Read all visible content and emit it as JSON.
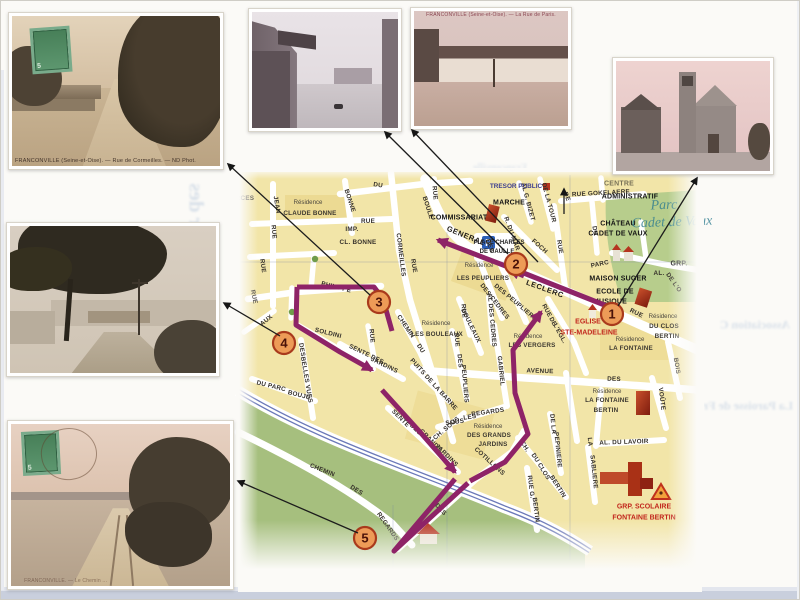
{
  "page": {
    "background": "#fbfaf7",
    "route_color": "#8E2367",
    "stop_fill": "#ED9B57",
    "stop_stroke": "#A93A1C"
  },
  "postcards": {
    "rue_de_cormeilles": {
      "caption": "FRANCONVILLE (Seine-et-Oise). — Rue de Cormeilles. — ND Phot.",
      "stamp_value": "5"
    },
    "rue_de_paris": {
      "caption": "FRANCONVILLE (Seine-et-Oise). — La Rue de Paris."
    },
    "chemin": {
      "caption": "FRANCONVILLE. — Le Chemin ...",
      "stamp_value": "5"
    }
  },
  "bleed": {
    "left": "Quartier des",
    "top": "Franconville",
    "right1": "Association C",
    "right2": "La Paroisse de Fr",
    "bottom": "Renseignements"
  },
  "map": {
    "stops": [
      {
        "n": "1",
        "x": 612,
        "y": 314
      },
      {
        "n": "2",
        "x": 516,
        "y": 264
      },
      {
        "n": "3",
        "x": 379,
        "y": 302
      },
      {
        "n": "4",
        "x": 284,
        "y": 343
      },
      {
        "n": "5",
        "x": 365,
        "y": 538
      }
    ],
    "arrows": [
      {
        "x1": 370,
        "y1": 295,
        "x2": 228,
        "y2": 164
      },
      {
        "x1": 508,
        "y1": 254,
        "x2": 385,
        "y2": 132
      },
      {
        "x1": 538,
        "y1": 262,
        "x2": 412,
        "y2": 130
      },
      {
        "x1": 564,
        "y1": 214,
        "x2": 564,
        "y2": 189
      },
      {
        "x1": 618,
        "y1": 306,
        "x2": 697,
        "y2": 178
      },
      {
        "x1": 280,
        "y1": 336,
        "x2": 224,
        "y2": 303
      },
      {
        "x1": 358,
        "y1": 533,
        "x2": 238,
        "y2": 481
      }
    ],
    "labels": [
      {
        "t": "DU",
        "x": 378,
        "y": 186,
        "r": 8,
        "c": "st"
      },
      {
        "t": "RUE",
        "x": 434,
        "y": 193,
        "r": 85,
        "c": "st"
      },
      {
        "t": "BOULE",
        "x": 427,
        "y": 208,
        "r": 72,
        "c": "st"
      },
      {
        "t": "GENERAL",
        "x": 466,
        "y": 236,
        "r": 22,
        "c": "st stBig"
      },
      {
        "t": "LECLERC",
        "x": 545,
        "y": 289,
        "r": 20,
        "c": "st stBig"
      },
      {
        "t": "RCES",
        "x": 245,
        "y": 199,
        "r": 0,
        "c": "st"
      },
      {
        "t": "RUE",
        "x": 273,
        "y": 232,
        "r": 85,
        "c": "st"
      },
      {
        "t": "JEAN",
        "x": 276,
        "y": 205,
        "r": 80,
        "c": "st"
      },
      {
        "t": "BONNE",
        "x": 349,
        "y": 201,
        "r": 72,
        "c": "st"
      },
      {
        "t": "RUE",
        "x": 368,
        "y": 222,
        "r": 0,
        "c": "st"
      },
      {
        "t": "IMP.",
        "x": 352,
        "y": 230,
        "r": 0,
        "c": "st"
      },
      {
        "t": "CL. BONNE",
        "x": 358,
        "y": 243,
        "r": 0,
        "c": "st"
      },
      {
        "t": "CORMEILLES",
        "x": 400,
        "y": 255,
        "r": 83,
        "c": "st"
      },
      {
        "t": "RUE",
        "x": 413,
        "y": 266,
        "r": 80,
        "c": "st"
      },
      {
        "t": "PHILIPPE",
        "x": 336,
        "y": 288,
        "r": 14,
        "c": "st"
      },
      {
        "t": "RUE",
        "x": 253,
        "y": 297,
        "r": 78,
        "c": "st"
      },
      {
        "t": "RUE",
        "x": 262,
        "y": 266,
        "r": 82,
        "c": "st"
      },
      {
        "t": "AUX",
        "x": 267,
        "y": 321,
        "r": -38,
        "c": "st"
      },
      {
        "t": "SOLDINI",
        "x": 328,
        "y": 334,
        "r": 14,
        "c": "st"
      },
      {
        "t": "DES",
        "x": 301,
        "y": 350,
        "r": 80,
        "c": "st"
      },
      {
        "t": "BELLES",
        "x": 304,
        "y": 370,
        "r": 80,
        "c": "st"
      },
      {
        "t": "VUES",
        "x": 308,
        "y": 394,
        "r": 80,
        "c": "st"
      },
      {
        "t": "DU PARC",
        "x": 271,
        "y": 387,
        "r": 14,
        "c": "st"
      },
      {
        "t": "BOUJU",
        "x": 299,
        "y": 396,
        "r": 14,
        "c": "st"
      },
      {
        "t": "RUE",
        "x": 371,
        "y": 336,
        "r": 85,
        "c": "st"
      },
      {
        "t": "SENTE DES",
        "x": 366,
        "y": 355,
        "r": 26,
        "c": "st"
      },
      {
        "t": "JARDINS",
        "x": 384,
        "y": 366,
        "r": 26,
        "c": "st"
      },
      {
        "t": "CHEMIN",
        "x": 405,
        "y": 327,
        "r": 56,
        "c": "st"
      },
      {
        "t": "DU",
        "x": 420,
        "y": 349,
        "r": 56,
        "c": "st"
      },
      {
        "t": "BOULEAUX",
        "x": 470,
        "y": 326,
        "r": 64,
        "c": "st"
      },
      {
        "t": "AL DES CEDRES",
        "x": 491,
        "y": 320,
        "r": 85,
        "c": "st"
      },
      {
        "t": "RUE",
        "x": 456,
        "y": 340,
        "r": 85,
        "c": "st"
      },
      {
        "t": "DES",
        "x": 459,
        "y": 361,
        "r": 85,
        "c": "st"
      },
      {
        "t": "PEUPLIERS",
        "x": 464,
        "y": 384,
        "r": 85,
        "c": "st"
      },
      {
        "t": "PUITS DE LA BARRE",
        "x": 433,
        "y": 385,
        "r": 48,
        "c": "st"
      },
      {
        "t": "SOUS",
        "x": 455,
        "y": 423,
        "r": -8,
        "c": "st"
      },
      {
        "t": "LES",
        "x": 470,
        "y": 418,
        "r": -8,
        "c": "st"
      },
      {
        "t": "REGARDS",
        "x": 488,
        "y": 413,
        "r": -8,
        "c": "st"
      },
      {
        "t": "SENTE",
        "x": 400,
        "y": 419,
        "r": 45,
        "c": "st"
      },
      {
        "t": "DES",
        "x": 415,
        "y": 430,
        "r": 45,
        "c": "st"
      },
      {
        "t": "GRANDS",
        "x": 430,
        "y": 441,
        "r": 45,
        "c": "st"
      },
      {
        "t": "JARDINS",
        "x": 446,
        "y": 456,
        "r": 45,
        "c": "st"
      },
      {
        "t": "CH. SOUS",
        "x": 447,
        "y": 429,
        "r": -40,
        "c": "st"
      },
      {
        "t": "COTILLONS",
        "x": 489,
        "y": 462,
        "r": 42,
        "c": "st"
      },
      {
        "t": "DES",
        "x": 440,
        "y": 510,
        "r": 48,
        "c": "st"
      },
      {
        "t": "REGARDS",
        "x": 387,
        "y": 527,
        "r": 55,
        "c": "st"
      },
      {
        "t": "CHEMIN",
        "x": 322,
        "y": 471,
        "r": 22,
        "c": "st"
      },
      {
        "t": "DES",
        "x": 356,
        "y": 491,
        "r": 32,
        "c": "st"
      },
      {
        "t": "CH.",
        "x": 524,
        "y": 447,
        "r": 58,
        "c": "st"
      },
      {
        "t": "DU CLOS",
        "x": 540,
        "y": 467,
        "r": 58,
        "c": "st"
      },
      {
        "t": "BERTIN",
        "x": 557,
        "y": 487,
        "r": 58,
        "c": "st"
      },
      {
        "t": "RUE G.",
        "x": 530,
        "y": 487,
        "r": 83,
        "c": "st"
      },
      {
        "t": "BERTIN",
        "x": 535,
        "y": 510,
        "r": 83,
        "c": "st"
      },
      {
        "t": "DE LA",
        "x": 552,
        "y": 424,
        "r": 84,
        "c": "st"
      },
      {
        "t": "PEPINIERE",
        "x": 557,
        "y": 450,
        "r": 84,
        "c": "st"
      },
      {
        "t": "AL. DU LAVOIR",
        "x": 624,
        "y": 443,
        "r": -2,
        "c": "st"
      },
      {
        "t": "LA",
        "x": 589,
        "y": 442,
        "r": 84,
        "c": "st"
      },
      {
        "t": "SABLIERE",
        "x": 593,
        "y": 472,
        "r": 84,
        "c": "st"
      },
      {
        "t": "AVENUE",
        "x": 540,
        "y": 372,
        "r": 2,
        "c": "st"
      },
      {
        "t": "DES",
        "x": 614,
        "y": 380,
        "r": 2,
        "c": "st"
      },
      {
        "t": "GABRIEL",
        "x": 500,
        "y": 371,
        "r": 84,
        "c": "st"
      },
      {
        "t": "RUE",
        "x": 463,
        "y": 311,
        "r": 85,
        "c": "st"
      },
      {
        "t": "DES CEDRES",
        "x": 494,
        "y": 302,
        "r": 52,
        "c": "st"
      },
      {
        "t": "DES PEUPLIERS",
        "x": 515,
        "y": 303,
        "r": 40,
        "c": "st"
      },
      {
        "t": "RUE",
        "x": 559,
        "y": 247,
        "r": 80,
        "c": "st"
      },
      {
        "t": "R. DU MAR",
        "x": 511,
        "y": 234,
        "r": 70,
        "c": "st"
      },
      {
        "t": "FOCH",
        "x": 539,
        "y": 247,
        "r": 42,
        "c": "st"
      },
      {
        "t": "AL G. BIZET",
        "x": 527,
        "y": 202,
        "r": 75,
        "c": "st"
      },
      {
        "t": "DE LA TOUR",
        "x": 548,
        "y": 203,
        "r": 75,
        "c": "st"
      },
      {
        "t": "DE",
        "x": 566,
        "y": 197,
        "r": 68,
        "c": "st"
      },
      {
        "t": "RUE GOKELAERE",
        "x": 601,
        "y": 194,
        "r": -3,
        "c": "st"
      },
      {
        "t": "DU",
        "x": 594,
        "y": 231,
        "r": 80,
        "c": "st"
      },
      {
        "t": "RUE",
        "x": 636,
        "y": 314,
        "r": 26,
        "c": "st"
      },
      {
        "t": "BOIS",
        "x": 676,
        "y": 366,
        "r": 80,
        "c": "st"
      },
      {
        "t": "VOÛTE",
        "x": 661,
        "y": 399,
        "r": 83,
        "c": "st"
      },
      {
        "t": "PARC",
        "x": 600,
        "y": 265,
        "r": -12,
        "c": "st"
      },
      {
        "t": "DES",
        "x": 489,
        "y": 246,
        "r": 70,
        "c": "st"
      },
      {
        "t": "RUE",
        "x": 546,
        "y": 311,
        "r": 62,
        "c": "st"
      },
      {
        "t": "DE",
        "x": 552,
        "y": 322,
        "r": 62,
        "c": "st"
      },
      {
        "t": "L'EGL.",
        "x": 559,
        "y": 334,
        "r": 62,
        "c": "st"
      },
      {
        "t": "AL.",
        "x": 659,
        "y": 274,
        "r": 0,
        "c": "st"
      },
      {
        "t": "DE L'O",
        "x": 673,
        "y": 283,
        "r": 55,
        "c": "st"
      },
      {
        "t": "GRP.",
        "x": 679,
        "y": 264,
        "r": 0,
        "c": "fac"
      },
      {
        "t": "COMMISSARIAT",
        "x": 459,
        "y": 218,
        "r": 0,
        "c": "fac"
      },
      {
        "t": "MARCHE",
        "x": 509,
        "y": 203,
        "r": 0,
        "c": "fac"
      },
      {
        "t": "TRESOR PUBLIC",
        "x": 516,
        "y": 187,
        "r": 0,
        "c": "blue"
      },
      {
        "t": "CENTRE",
        "x": 619,
        "y": 184,
        "r": 0,
        "c": "fac dim"
      },
      {
        "t": "ADMINISTRATIF",
        "x": 630,
        "y": 197,
        "r": 0,
        "c": "fac"
      },
      {
        "t": "CHÂTEAU",
        "x": 618,
        "y": 224,
        "r": 0,
        "c": "fac"
      },
      {
        "t": "CADET DE VAUX",
        "x": 618,
        "y": 234,
        "r": 0,
        "c": "fac"
      },
      {
        "t": "MAISON SUGER",
        "x": 618,
        "y": 279,
        "r": 0,
        "c": "fac"
      },
      {
        "t": "ECOLE DE",
        "x": 615,
        "y": 292,
        "r": 0,
        "c": "fac"
      },
      {
        "t": "MUSIQUE",
        "x": 610,
        "y": 302,
        "r": 0,
        "c": "fac"
      },
      {
        "t": "PLACE CHARLES",
        "x": 499,
        "y": 243,
        "r": 0,
        "c": "plc"
      },
      {
        "t": "DE GAULLE",
        "x": 497,
        "y": 252,
        "r": 0,
        "c": "plc"
      },
      {
        "t": "EGLISE",
        "x": 588,
        "y": 322,
        "r": 0,
        "c": "red"
      },
      {
        "t": "STE-MADELEINE",
        "x": 589,
        "y": 333,
        "r": 0,
        "c": "red"
      },
      {
        "t": "GRP. SCOLAIRE",
        "x": 644,
        "y": 507,
        "r": 0,
        "c": "red"
      },
      {
        "t": "FONTAINE BERTIN",
        "x": 644,
        "y": 518,
        "r": 0,
        "c": "red"
      },
      {
        "t": "Résidence",
        "x": 308,
        "y": 203,
        "r": 0,
        "c": "res"
      },
      {
        "t": "CLAUDE BONNE",
        "x": 310,
        "y": 214,
        "r": 0,
        "c": "res2"
      },
      {
        "t": "Résidence",
        "x": 479,
        "y": 266,
        "r": 0,
        "c": "res"
      },
      {
        "t": "LES PEUPLIERS",
        "x": 483,
        "y": 279,
        "r": 0,
        "c": "res2"
      },
      {
        "t": "Résidence",
        "x": 436,
        "y": 324,
        "r": 0,
        "c": "res"
      },
      {
        "t": "LES BOULEAUX",
        "x": 437,
        "y": 335,
        "r": 0,
        "c": "res2"
      },
      {
        "t": "Résidence",
        "x": 663,
        "y": 317,
        "r": 0,
        "c": "res"
      },
      {
        "t": "DU CLOS",
        "x": 664,
        "y": 327,
        "r": 0,
        "c": "res2"
      },
      {
        "t": "BERTIN",
        "x": 667,
        "y": 337,
        "r": 0,
        "c": "res2"
      },
      {
        "t": "Résidence",
        "x": 630,
        "y": 340,
        "r": 0,
        "c": "res"
      },
      {
        "t": "LA FONTAINE",
        "x": 631,
        "y": 349,
        "r": 0,
        "c": "res2"
      },
      {
        "t": "Résidence",
        "x": 528,
        "y": 337,
        "r": 0,
        "c": "res"
      },
      {
        "t": "LES VERGERS",
        "x": 532,
        "y": 346,
        "r": 0,
        "c": "res2"
      },
      {
        "t": "Résidence",
        "x": 488,
        "y": 427,
        "r": 0,
        "c": "res"
      },
      {
        "t": "DES GRANDS",
        "x": 489,
        "y": 436,
        "r": 0,
        "c": "res2"
      },
      {
        "t": "JARDINS",
        "x": 493,
        "y": 445,
        "r": 0,
        "c": "res2"
      },
      {
        "t": "Résidence",
        "x": 607,
        "y": 392,
        "r": 0,
        "c": "res"
      },
      {
        "t": "LA FONTAINE",
        "x": 607,
        "y": 401,
        "r": 0,
        "c": "res2"
      },
      {
        "t": "BERTIN",
        "x": 606,
        "y": 411,
        "r": 0,
        "c": "res2"
      },
      {
        "t": "Parc",
        "x": 664,
        "y": 206,
        "r": -2,
        "c": "parc"
      },
      {
        "t": "Cadet de Vaux",
        "x": 672,
        "y": 223,
        "r": -2,
        "c": "parc"
      }
    ]
  }
}
